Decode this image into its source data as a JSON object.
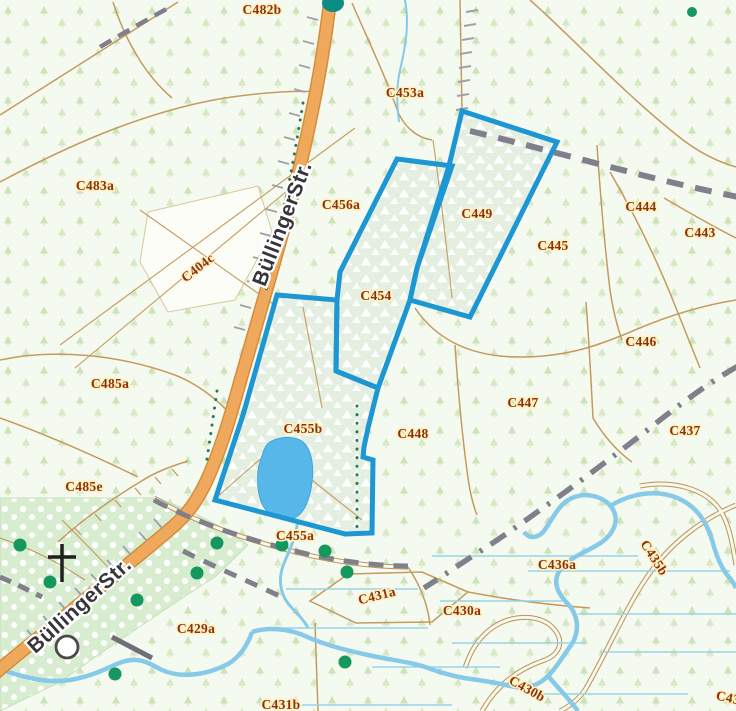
{
  "map": {
    "road_label": "BüllingerStr.",
    "selected_parcels": [
      "C449",
      "C454",
      "C455b"
    ],
    "parcels": {
      "C482b": "C482b",
      "C453a": "C453a",
      "C483a": "C483a",
      "C404c": "C404c",
      "C456a": "C456a",
      "C449": "C449",
      "C444": "C444",
      "C443": "C443",
      "C445": "C445",
      "C454": "C454",
      "C446": "C446",
      "C485a": "C485a",
      "C447": "C447",
      "C437": "C437",
      "C448": "C448",
      "C455b": "C455b",
      "C485e": "C485e",
      "C455a": "C455a",
      "C436a": "C436a",
      "C435b": "C435b",
      "C429a": "C429a",
      "C431a": "C431a",
      "C430a": "C430a",
      "C430b": "C430b",
      "C431b": "C431b",
      "C43_partial": "C43"
    },
    "colors": {
      "selection_stroke": "#1d96d4",
      "road_fill": "#f0a95c",
      "water": "#7cc6e9",
      "parcel_label": "#8e3110",
      "track_dash": "#80808c",
      "tree_dot": "#14985e",
      "background": "#f5faf0"
    }
  }
}
